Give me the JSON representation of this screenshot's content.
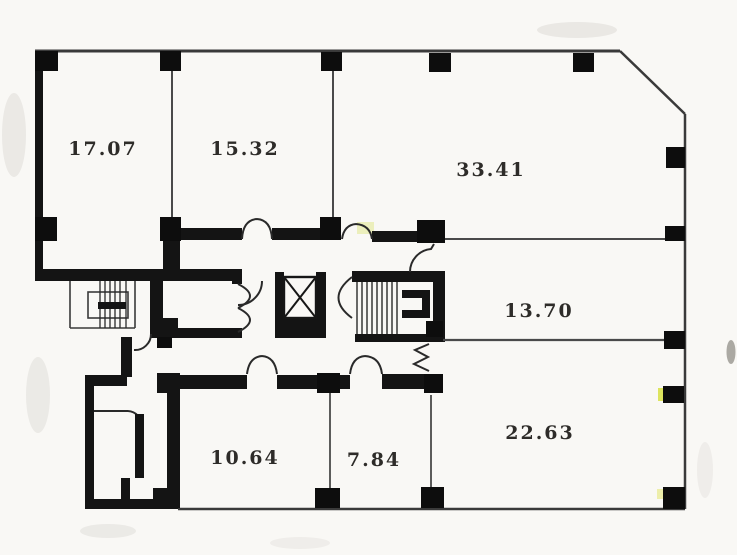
{
  "page": {
    "background_color": "#f9f8f5",
    "line_color": "#3a3a3a",
    "wall_fill_color": "#141414",
    "label_color": "#2e2c29",
    "scan_artifact_color": "#d9e14e"
  },
  "floorplan": {
    "area_unit": "坪",
    "rooms": [
      {
        "id": "room-17-07",
        "area": "17.07",
        "label": "17.07坪"
      },
      {
        "id": "room-15-32",
        "area": "15.32",
        "label": "15.32坪"
      },
      {
        "id": "room-33-41",
        "area": "33.41",
        "label": "33.41坪"
      },
      {
        "id": "room-13-70",
        "area": "13.70",
        "label": "13.70坪"
      },
      {
        "id": "room-22-63",
        "area": "22.63",
        "label": "22.63坪"
      },
      {
        "id": "room-10-64",
        "area": "10.64",
        "label": "10.64坪"
      },
      {
        "id": "room-7-84",
        "area": "7.84",
        "label": "7.84坪"
      }
    ],
    "features": [
      "elevator",
      "main-staircase",
      "external-staircase",
      "restroom-block",
      "corridor",
      "door-swings",
      "structural-columns",
      "chamfered-corner"
    ]
  }
}
